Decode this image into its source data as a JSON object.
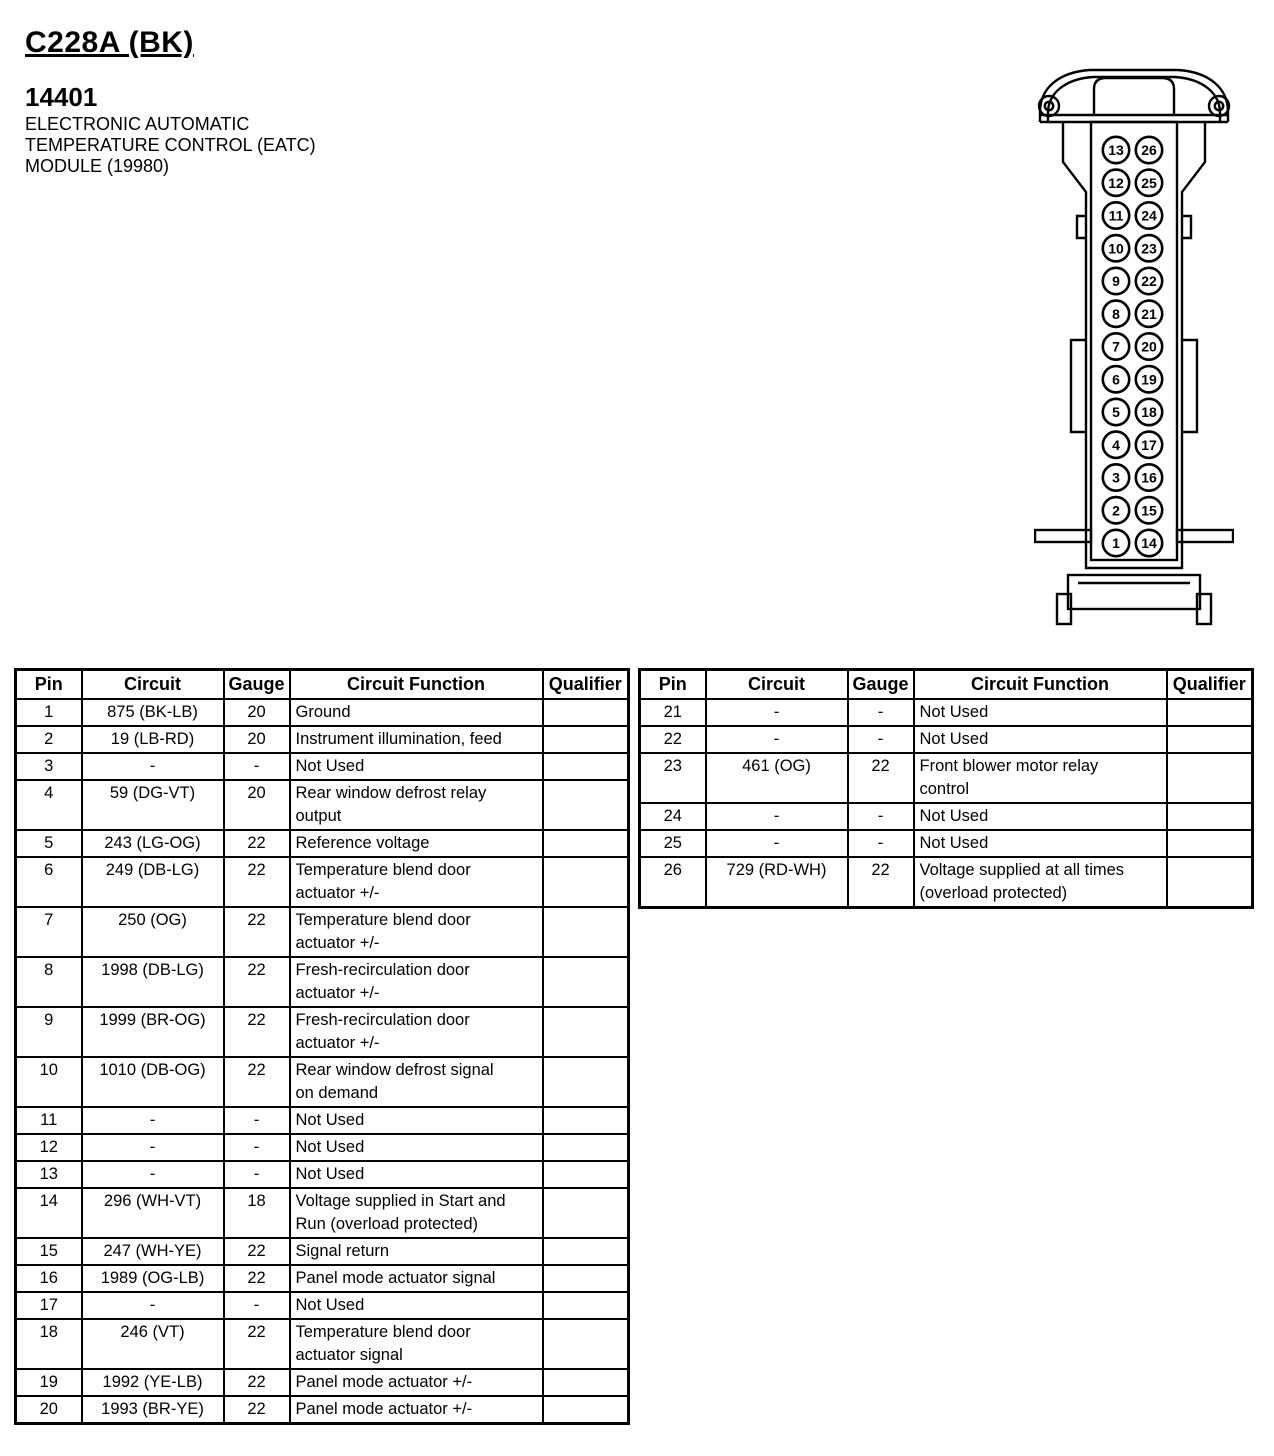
{
  "header": {
    "connector_id": "C228A (BK)",
    "part_number": "14401",
    "description_lines": [
      "ELECTRONIC AUTOMATIC",
      "TEMPERATURE CONTROL (EATC)",
      "MODULE (19980)"
    ]
  },
  "connector": {
    "name": "26-pin connector face view",
    "pins_left_column_top_to_bottom": [
      "13",
      "12",
      "11",
      "10",
      "9",
      "8",
      "7",
      "6",
      "5",
      "4",
      "3",
      "2",
      "1"
    ],
    "pins_right_column_top_to_bottom": [
      "26",
      "25",
      "24",
      "23",
      "22",
      "21",
      "20",
      "19",
      "18",
      "17",
      "16",
      "15",
      "14"
    ],
    "line_color": "#000000"
  },
  "tables": {
    "columns": [
      "Pin",
      "Circuit",
      "Gauge",
      "Circuit Function",
      "Qualifier"
    ],
    "left_rows": [
      {
        "pin": "1",
        "circuit": "875 (BK-LB)",
        "gauge": "20",
        "function": "Ground",
        "qualifier": ""
      },
      {
        "pin": "2",
        "circuit": "19 (LB-RD)",
        "gauge": "20",
        "function": "Instrument illumination, feed",
        "qualifier": ""
      },
      {
        "pin": "3",
        "circuit": "-",
        "gauge": "-",
        "function": "Not Used",
        "qualifier": ""
      },
      {
        "pin": "4",
        "circuit": "59 (DG-VT)",
        "gauge": "20",
        "function": "Rear window defrost relay\noutput",
        "qualifier": ""
      },
      {
        "pin": "5",
        "circuit": "243 (LG-OG)",
        "gauge": "22",
        "function": "Reference voltage",
        "qualifier": ""
      },
      {
        "pin": "6",
        "circuit": "249 (DB-LG)",
        "gauge": "22",
        "function": "Temperature blend door\nactuator +/-",
        "qualifier": ""
      },
      {
        "pin": "7",
        "circuit": "250 (OG)",
        "gauge": "22",
        "function": "Temperature blend door\nactuator +/-",
        "qualifier": ""
      },
      {
        "pin": "8",
        "circuit": "1998 (DB-LG)",
        "gauge": "22",
        "function": "Fresh-recirculation door\nactuator +/-",
        "qualifier": ""
      },
      {
        "pin": "9",
        "circuit": "1999 (BR-OG)",
        "gauge": "22",
        "function": "Fresh-recirculation door\nactuator +/-",
        "qualifier": ""
      },
      {
        "pin": "10",
        "circuit": "1010 (DB-OG)",
        "gauge": "22",
        "function": "Rear window defrost signal\non demand",
        "qualifier": ""
      },
      {
        "pin": "11",
        "circuit": "-",
        "gauge": "-",
        "function": "Not Used",
        "qualifier": ""
      },
      {
        "pin": "12",
        "circuit": "-",
        "gauge": "-",
        "function": "Not Used",
        "qualifier": ""
      },
      {
        "pin": "13",
        "circuit": "-",
        "gauge": "-",
        "function": "Not Used",
        "qualifier": ""
      },
      {
        "pin": "14",
        "circuit": "296 (WH-VT)",
        "gauge": "18",
        "function": "Voltage supplied in Start and\nRun (overload protected)",
        "qualifier": ""
      },
      {
        "pin": "15",
        "circuit": "247 (WH-YE)",
        "gauge": "22",
        "function": "Signal return",
        "qualifier": ""
      },
      {
        "pin": "16",
        "circuit": "1989 (OG-LB)",
        "gauge": "22",
        "function": "Panel mode actuator signal",
        "qualifier": ""
      },
      {
        "pin": "17",
        "circuit": "-",
        "gauge": "-",
        "function": "Not Used",
        "qualifier": ""
      },
      {
        "pin": "18",
        "circuit": "246 (VT)",
        "gauge": "22",
        "function": "Temperature blend door\nactuator signal",
        "qualifier": ""
      },
      {
        "pin": "19",
        "circuit": "1992 (YE-LB)",
        "gauge": "22",
        "function": "Panel mode actuator +/-",
        "qualifier": ""
      },
      {
        "pin": "20",
        "circuit": "1993 (BR-YE)",
        "gauge": "22",
        "function": "Panel mode actuator +/-",
        "qualifier": ""
      }
    ],
    "right_rows": [
      {
        "pin": "21",
        "circuit": "-",
        "gauge": "-",
        "function": "Not Used",
        "qualifier": ""
      },
      {
        "pin": "22",
        "circuit": "-",
        "gauge": "-",
        "function": "Not Used",
        "qualifier": ""
      },
      {
        "pin": "23",
        "circuit": "461 (OG)",
        "gauge": "22",
        "function": "Front blower motor relay\ncontrol",
        "qualifier": ""
      },
      {
        "pin": "24",
        "circuit": "-",
        "gauge": "-",
        "function": "Not Used",
        "qualifier": ""
      },
      {
        "pin": "25",
        "circuit": "-",
        "gauge": "-",
        "function": "Not Used",
        "qualifier": ""
      },
      {
        "pin": "26",
        "circuit": "729 (RD-WH)",
        "gauge": "22",
        "function": "Voltage supplied at all times\n(overload protected)",
        "qualifier": ""
      }
    ]
  }
}
